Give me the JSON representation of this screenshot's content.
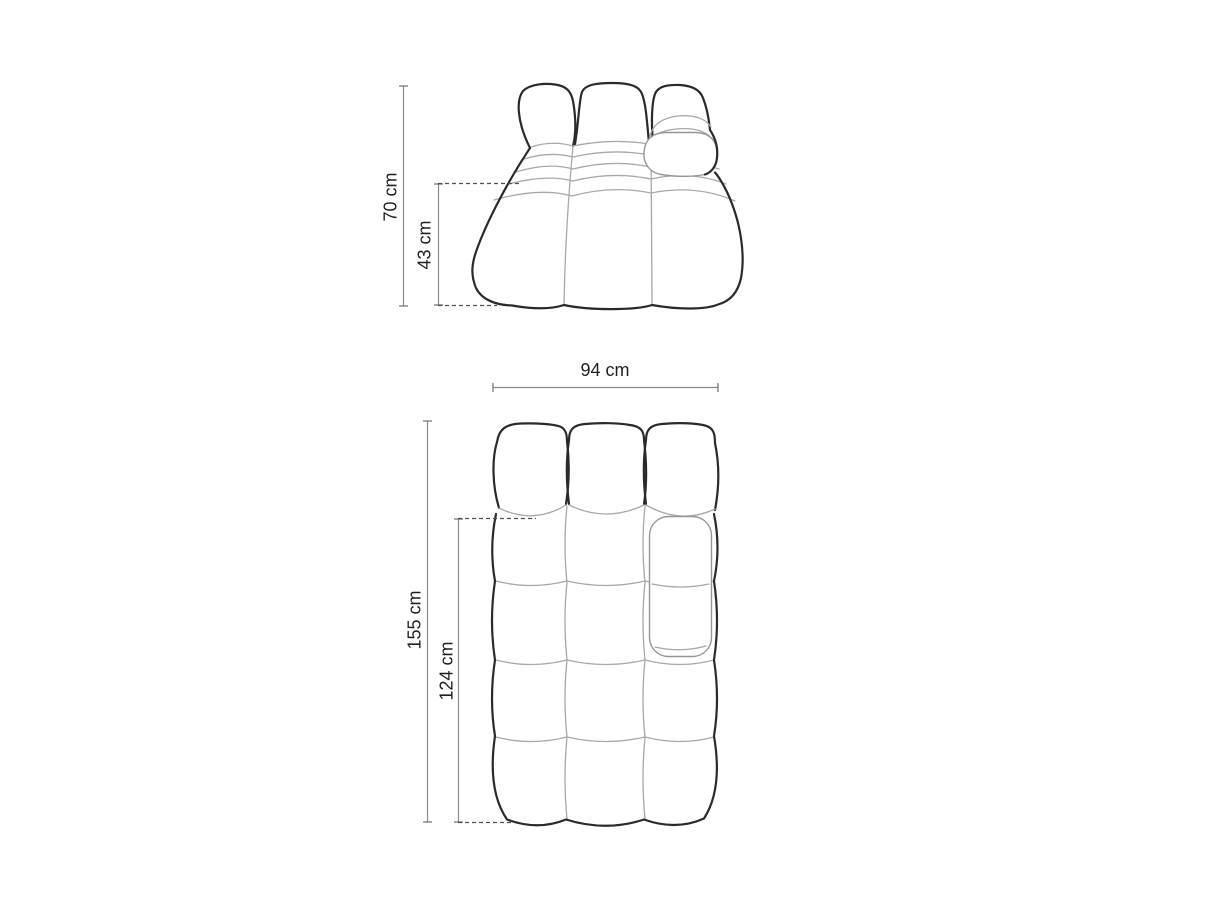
{
  "page": {
    "background": "#ffffff",
    "unit": "cm"
  },
  "colors": {
    "outline": "#2a2a2a",
    "inner_line": "#a8a8a8",
    "armrest_line": "#969696",
    "dimension_line": "#8a8a8a",
    "dashed_line": "#4f4f4f",
    "label_text": "#1f1f1f"
  },
  "front_view": {
    "name": "sofa module front elevation",
    "dimensions": [
      {
        "id": "total-height",
        "label": "70 cm",
        "value": 70,
        "unit": "cm",
        "orientation": "vertical"
      },
      {
        "id": "seat-height",
        "label": "43 cm",
        "value": 43,
        "unit": "cm",
        "orientation": "vertical"
      }
    ]
  },
  "top_view": {
    "name": "sofa module plan view",
    "dimensions": [
      {
        "id": "width",
        "label": "94 cm",
        "value": 94,
        "unit": "cm",
        "orientation": "horizontal"
      },
      {
        "id": "total-depth",
        "label": "155 cm",
        "value": 155,
        "unit": "cm",
        "orientation": "vertical"
      },
      {
        "id": "seat-depth",
        "label": "124 cm",
        "value": 124,
        "unit": "cm",
        "orientation": "vertical"
      }
    ]
  }
}
